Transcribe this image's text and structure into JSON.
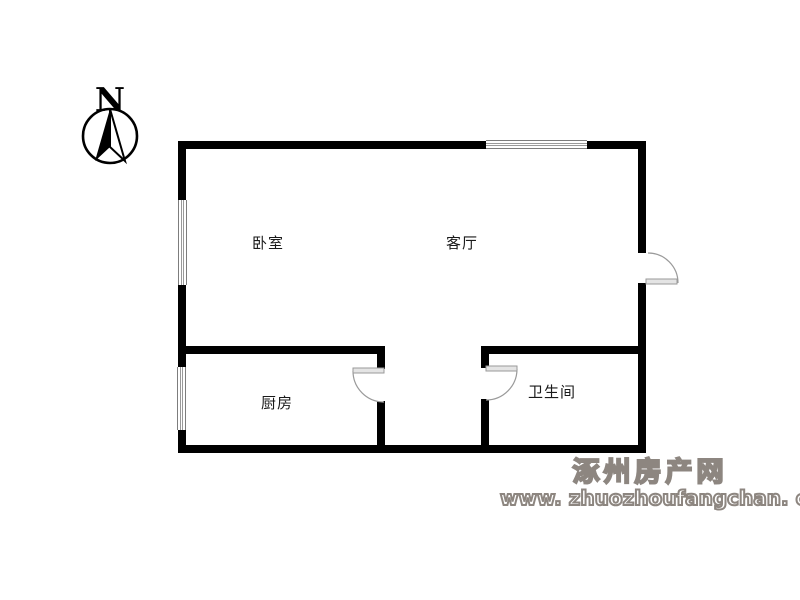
{
  "compass": {
    "north_label": "N"
  },
  "floorplan": {
    "rooms": [
      {
        "name": "bedroom",
        "label": "卧室"
      },
      {
        "name": "living-room",
        "label": "客厅"
      },
      {
        "name": "kitchen",
        "label": "厨房"
      },
      {
        "name": "bathroom",
        "label": "卫生间"
      }
    ],
    "features": {
      "windows": [
        "top-window",
        "bedroom-left-window",
        "kitchen-left-window"
      ],
      "doors": [
        "entry-door",
        "kitchen-door",
        "bathroom-door"
      ]
    }
  },
  "watermark": {
    "site_name": "涿州房产网",
    "site_url": "www. zhuozhoufangchan. com"
  },
  "colors": {
    "wall": "#000000",
    "window_line": "#7d7d7d",
    "door_line": "#9a9a9a",
    "door_leaf_fill": "#e4e4e4",
    "watermark_gray": "#8d8680"
  }
}
